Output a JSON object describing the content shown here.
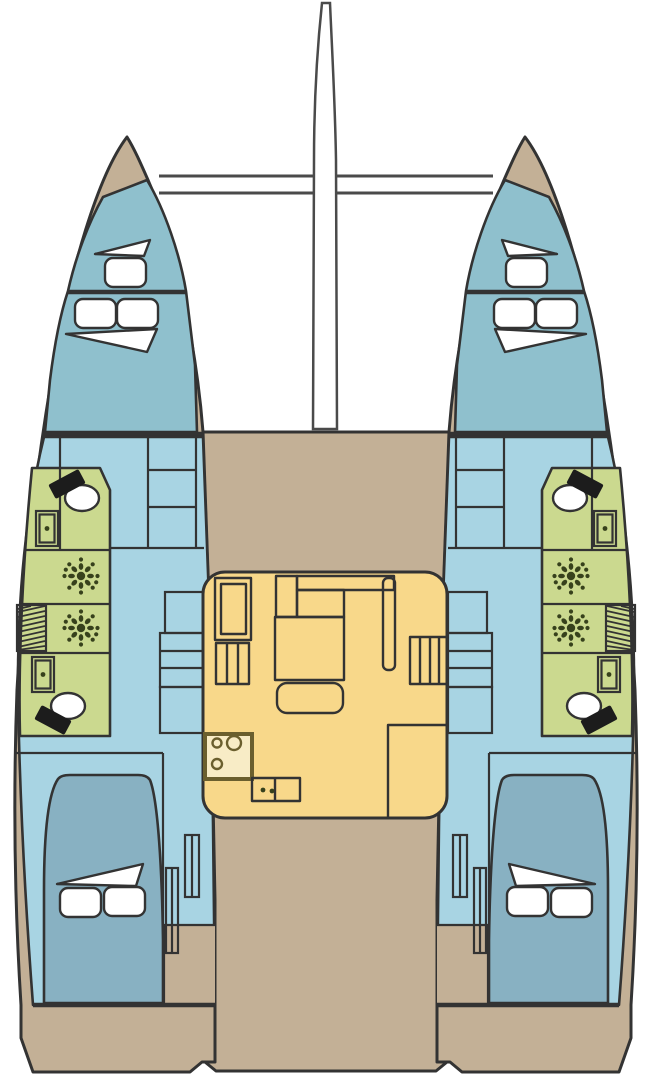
{
  "diagram": {
    "kind": "catamaran-deck-plan",
    "colors": {
      "background": "#ffffff",
      "outline": "#333333",
      "beam_gray": "#4a4a4a",
      "deck": "#c3b096",
      "cabin_blue": "#8fc0cd",
      "interior_blue": "#a8d4e3",
      "berth_blue": "#88b1c2",
      "bathroom_green": "#cbd98f",
      "salon_yellow": "#f8d88a",
      "stove_fill": "#f8ecc6",
      "stove_border": "#6b5f2e",
      "fixture_dark": "#37411c",
      "furniture_white": "#ffffff",
      "seat_black": "#1c1c1c"
    }
  }
}
